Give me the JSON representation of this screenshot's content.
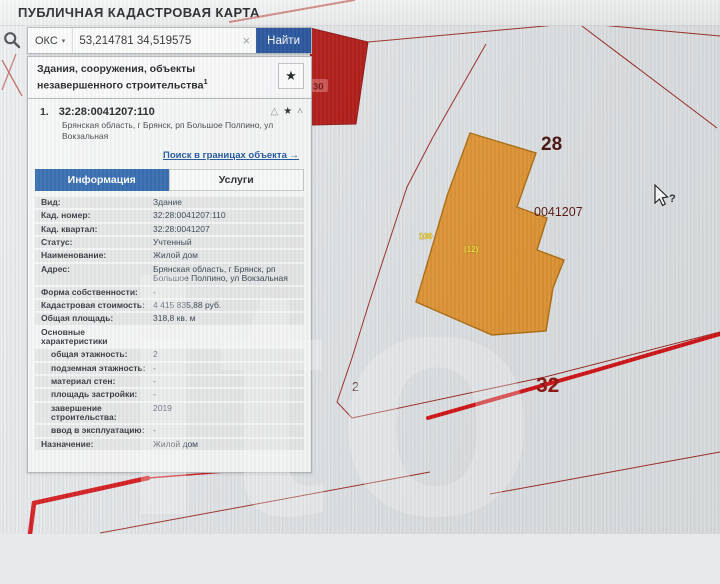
{
  "header": {
    "title": "ПУБЛИЧНАЯ КАДАСТРОВАЯ КАРТА"
  },
  "search": {
    "category": "ОКС",
    "caret": "▾",
    "value": "53,214781 34,519575",
    "clear": "×",
    "find_label": "Найти"
  },
  "section": {
    "title": "Здания, сооружения, объекты незавершенного строительства",
    "sup": "1",
    "star": "★"
  },
  "result": {
    "index": "1.",
    "cad_number": "32:28:0041207:110",
    "address": "Брянская область, г Брянск, рп Большое Полпино, ул Вокзальная",
    "icons": {
      "warning": "△",
      "star": "★",
      "collapse": "˄"
    },
    "link": "Поиск в границах объекта →",
    "tabs": [
      {
        "label": "Информация",
        "active": true
      },
      {
        "label": "Услуги",
        "active": false
      }
    ],
    "rows": [
      {
        "label": "Вид:",
        "value": "Здание"
      },
      {
        "label": "Кад. номер:",
        "value": "32:28:0041207:110"
      },
      {
        "label": "Кад. квартал:",
        "value": "32:28:0041207"
      },
      {
        "label": "Статус:",
        "value": "Учтенный"
      },
      {
        "label": "Наименование:",
        "value": "Жилой дом"
      },
      {
        "label": "Адрес:",
        "value": "Брянская область, г Брянск, рп Большое Полпино, ул Вокзальная"
      },
      {
        "label": "Форма собственности:",
        "value": "-"
      },
      {
        "label": "Кадастровая стоимость:",
        "value": "4 415 835,88 руб."
      },
      {
        "label": "Общая площадь:",
        "value": "318,8 кв. м"
      },
      {
        "label": "Основные характеристики",
        "value": "",
        "group": true
      },
      {
        "label": "общая этажность:",
        "value": "2",
        "indent": true
      },
      {
        "label": "подземная этажность:",
        "value": "-",
        "indent": true
      },
      {
        "label": "материал стен:",
        "value": "-",
        "indent": true
      },
      {
        "label": "площадь застройки:",
        "value": "-",
        "indent": true
      },
      {
        "label": "завершение строительства:",
        "value": "2019",
        "indent": true
      },
      {
        "label": "ввод в эксплуатацию:",
        "value": "-",
        "indent": true
      },
      {
        "label": "Назначение:",
        "value": "Жилой дом"
      }
    ]
  },
  "map": {
    "labels": {
      "parcel_28": "28",
      "quarter": "0041207",
      "parcel_2": "2",
      "road_32": "32",
      "red_parcel": "30",
      "building_a": "100",
      "building_b": "(12)"
    },
    "colors": {
      "building_fill": "#e2932d",
      "building_stroke": "#b06f12",
      "red_parcel_fill": "#b21511",
      "red_parcel_stroke": "#8c1310",
      "boundary": "#9c2b24",
      "road": "#d41417",
      "label_dark_red": "#7c1a15",
      "label_yellow": "#ffe33c"
    }
  },
  "cursor": {
    "glyph": "?"
  },
  "watermark": "ito"
}
